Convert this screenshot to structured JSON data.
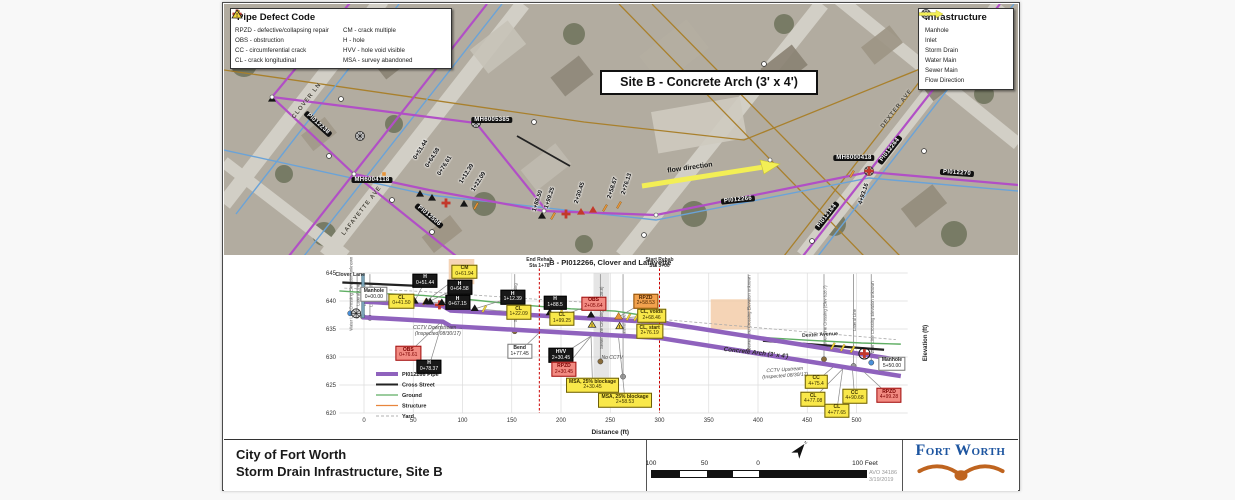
{
  "map": {
    "pipe_defect_legend": {
      "title": "Pipe Defect Code",
      "items": [
        {
          "sym": "tri",
          "color": "#c3392b",
          "code": "RPZD",
          "desc": "defective/collapsing repair"
        },
        {
          "sym": "cross",
          "color": "#c3392b",
          "code": "OBS",
          "desc": "obstruction"
        },
        {
          "sym": "tick",
          "color": "#e8963c",
          "code": "CC",
          "desc": "circumferential crack"
        },
        {
          "sym": "tick",
          "color": "#f0d23c",
          "code": "CL",
          "desc": "crack longitudinal"
        },
        {
          "sym": "tick",
          "color": "#e8963c",
          "code": "CM",
          "desc": "crack multiple"
        },
        {
          "sym": "tri",
          "color": "#151515",
          "code": "H",
          "desc": "hole"
        },
        {
          "sym": "tri",
          "color": "#151515",
          "code": "HVV",
          "desc": "hole void visible"
        },
        {
          "sym": "warn",
          "color": "#f2d43c",
          "code": "MSA",
          "desc": "survey abandoned"
        }
      ]
    },
    "infrastructure_legend": {
      "title": "Infrastructure",
      "items": [
        {
          "sym": "manhole",
          "color": "#333333",
          "label": "Manhole"
        },
        {
          "sym": "inlet",
          "color": "#333333",
          "label": "Inlet"
        },
        {
          "sym": "line",
          "color": "#b14fc6",
          "h": 2.6,
          "label": "Storm Drain"
        },
        {
          "sym": "line",
          "color": "#6aa3d8",
          "h": 1.4,
          "label": "Water Main"
        },
        {
          "sym": "line",
          "color": "#a9802c",
          "h": 1.4,
          "label": "Sewer Main"
        },
        {
          "sym": "arrow",
          "color": "#f3ef55",
          "label": "Flow Direction"
        }
      ]
    },
    "site_title": "Site B - Concrete Arch (3' x 4')",
    "labels": [
      {
        "text": "PI012238",
        "x": 94,
        "y": 120,
        "rot": 42,
        "cls": "pill"
      },
      {
        "text": "MH6005385",
        "x": 268,
        "y": 116,
        "rot": 0,
        "cls": "pill"
      },
      {
        "text": "MH6004118",
        "x": 148,
        "y": 176,
        "rot": 0,
        "cls": "pill"
      },
      {
        "text": "PI012506",
        "x": 205,
        "y": 212,
        "rot": 40,
        "cls": "pill"
      },
      {
        "text": "PI012266",
        "x": 514,
        "y": 196,
        "rot": -6,
        "cls": "pill"
      },
      {
        "text": "MH6000418",
        "x": 630,
        "y": 154,
        "rot": 0,
        "cls": "pill"
      },
      {
        "text": "PI012264",
        "x": 666,
        "y": 146,
        "rot": -52,
        "cls": "pill"
      },
      {
        "text": "PI012270",
        "x": 733,
        "y": 169,
        "rot": 4,
        "cls": "pill"
      },
      {
        "text": "PI012164",
        "x": 603,
        "y": 212,
        "rot": -52,
        "cls": "pill"
      },
      {
        "text": "CLOVER LN",
        "x": 83,
        "y": 97,
        "rot": -52,
        "cls": "street"
      },
      {
        "text": "LAFAYETTE AVE",
        "x": 138,
        "y": 207,
        "rot": -52,
        "cls": "street"
      },
      {
        "text": "DEXTER AVE",
        "x": 673,
        "y": 105,
        "rot": -52,
        "cls": "street"
      },
      {
        "text": "0+51.44",
        "x": 197,
        "y": 146,
        "rot": -58,
        "cls": "sta"
      },
      {
        "text": "0+64.58",
        "x": 209,
        "y": 154,
        "rot": -58,
        "cls": "sta"
      },
      {
        "text": "0+76.61",
        "x": 221,
        "y": 162,
        "rot": -58,
        "cls": "sta"
      },
      {
        "text": "1+12.39",
        "x": 243,
        "y": 170,
        "rot": -58,
        "cls": "sta"
      },
      {
        "text": "1+22.09",
        "x": 255,
        "y": 178,
        "rot": -58,
        "cls": "sta"
      },
      {
        "text": "1+88.50",
        "x": 314,
        "y": 197,
        "rot": -72,
        "cls": "sta"
      },
      {
        "text": "1+99.25",
        "x": 326,
        "y": 194,
        "rot": -72,
        "cls": "sta"
      },
      {
        "text": "2+30.45",
        "x": 356,
        "y": 189,
        "rot": -72,
        "cls": "sta"
      },
      {
        "text": "2+58.67",
        "x": 389,
        "y": 184,
        "rot": -72,
        "cls": "sta"
      },
      {
        "text": "2+76.13",
        "x": 403,
        "y": 180,
        "rot": -72,
        "cls": "sta"
      },
      {
        "text": "4+93.16",
        "x": 640,
        "y": 190,
        "rot": -72,
        "cls": "sta"
      },
      {
        "text": "flow direction",
        "x": 466,
        "y": 164,
        "rot": -8,
        "cls": "flow"
      }
    ],
    "markers": [
      {
        "x": 48,
        "y": 95,
        "t": "triBlack"
      },
      {
        "x": 136,
        "y": 132,
        "t": "manhole"
      },
      {
        "x": 252,
        "y": 119,
        "t": "manhole"
      },
      {
        "x": 645,
        "y": 167,
        "t": "manhole"
      },
      {
        "x": 645,
        "y": 167,
        "t": "crossRed"
      },
      {
        "x": 196,
        "y": 190,
        "t": "triBlack"
      },
      {
        "x": 208,
        "y": 194,
        "t": "triBlack"
      },
      {
        "x": 222,
        "y": 199,
        "t": "crossRed"
      },
      {
        "x": 240,
        "y": 200,
        "t": "triBlack"
      },
      {
        "x": 252,
        "y": 202,
        "t": "tickOrange"
      },
      {
        "x": 318,
        "y": 212,
        "t": "triBlack"
      },
      {
        "x": 329,
        "y": 212,
        "t": "tickOrange"
      },
      {
        "x": 342,
        "y": 210,
        "t": "crossRed"
      },
      {
        "x": 357,
        "y": 208,
        "t": "triRed"
      },
      {
        "x": 369,
        "y": 206,
        "t": "triRed"
      },
      {
        "x": 381,
        "y": 204,
        "t": "tickOrange"
      },
      {
        "x": 395,
        "y": 201,
        "t": "tickOrange"
      },
      {
        "x": 628,
        "y": 170,
        "t": "tickOrange"
      },
      {
        "x": 160,
        "y": 170,
        "t": "sqOrange"
      },
      {
        "x": 105,
        "y": 152,
        "t": "inlet"
      },
      {
        "x": 168,
        "y": 196,
        "t": "inlet"
      },
      {
        "x": 208,
        "y": 228,
        "t": "inlet"
      },
      {
        "x": 310,
        "y": 118,
        "t": "inlet"
      },
      {
        "x": 420,
        "y": 231,
        "t": "inlet"
      },
      {
        "x": 588,
        "y": 237,
        "t": "inlet"
      },
      {
        "x": 700,
        "y": 147,
        "t": "inlet"
      },
      {
        "x": 117,
        "y": 95,
        "t": "inlet"
      },
      {
        "x": 540,
        "y": 60,
        "t": "inlet"
      },
      {
        "x": 48,
        "y": 93,
        "t": "dotWhite"
      },
      {
        "x": 130,
        "y": 170,
        "t": "dotWhite"
      },
      {
        "x": 320,
        "y": 207,
        "t": "dotWhite"
      },
      {
        "x": 432,
        "y": 211,
        "t": "dotWhite"
      },
      {
        "x": 546,
        "y": 156,
        "t": "dotWhite"
      }
    ]
  },
  "chart_data": {
    "type": "line",
    "title": "B - PI012266, Clover and Lafayette",
    "xlabel": "Distance (ft)",
    "ylabel": "Elevation (ft)",
    "xlim": [
      -25,
      560
    ],
    "ylim": [
      620,
      645
    ],
    "xticks": [
      0,
      50,
      100,
      150,
      200,
      250,
      300,
      350,
      400,
      450,
      500
    ],
    "yticks": [
      620,
      625,
      630,
      635,
      640,
      645
    ],
    "grid": true,
    "legend": [
      {
        "label": "PI012266 Pipe",
        "color": "#8f62bd",
        "width": 4
      },
      {
        "label": "Cross Street",
        "color": "#222222",
        "width": 2
      },
      {
        "label": "Ground",
        "color": "#5fae63",
        "width": 1.2
      },
      {
        "label": "Structure",
        "color": "#e8853d",
        "width": 1.2
      },
      {
        "label": "Yard",
        "color": "#999999",
        "width": 0.8,
        "dash": "3,2"
      }
    ],
    "series": [
      {
        "name": "Yard",
        "color": "#aaaaaa",
        "width": 0.8,
        "dash": "3,2",
        "points": [
          [
            -20,
            642.3
          ],
          [
            60,
            641.7
          ],
          [
            150,
            640.6
          ],
          [
            240,
            639.6
          ]
        ]
      },
      {
        "name": "Yard2",
        "color": "#aaaaaa",
        "width": 0.8,
        "dash": "3,2",
        "points": [
          [
            310,
            636.6
          ],
          [
            540,
            633.1
          ]
        ]
      },
      {
        "name": "Ground",
        "color": "#5fae63",
        "width": 1.4,
        "points": [
          [
            -25,
            641.8
          ],
          [
            0,
            641.5
          ],
          [
            60,
            641
          ],
          [
            110,
            640.2
          ],
          [
            160,
            639.3
          ],
          [
            210,
            638.6
          ],
          [
            255,
            638.2
          ],
          [
            285,
            637.4
          ],
          [
            310,
            636.2
          ],
          [
            345,
            634.8
          ],
          [
            395,
            633.6
          ],
          [
            450,
            633
          ],
          [
            505,
            632.5
          ],
          [
            545,
            632.3
          ]
        ]
      },
      {
        "name": "Clover Lane",
        "color": "#222222",
        "width": 2.2,
        "points": [
          [
            -22,
            643.3
          ],
          [
            55,
            642.7
          ]
        ]
      },
      {
        "name": "Dexter Avenue",
        "color": "#222222",
        "width": 2.2,
        "points": [
          [
            405,
            632.9
          ],
          [
            528,
            631.3
          ]
        ]
      },
      {
        "name": "Pipe top",
        "color": "#8f62bd",
        "width": 4.5,
        "points": [
          [
            -2,
            639.9
          ],
          [
            80,
            639.1
          ],
          [
            88,
            638.3
          ],
          [
            300,
            636.2
          ],
          [
            545,
            629.4
          ]
        ]
      },
      {
        "name": "Pipe bottom",
        "color": "#8f62bd",
        "width": 4.5,
        "points": [
          [
            -2,
            637.1
          ],
          [
            80,
            636.3
          ],
          [
            88,
            635.5
          ],
          [
            300,
            633.4
          ],
          [
            545,
            626.6
          ]
        ]
      }
    ],
    "structures": [
      {
        "x1": 86,
        "x2": 112,
        "y1": 647.5,
        "y2": 643
      },
      {
        "x1": 352,
        "x2": 392,
        "y1": 640.3,
        "y2": 634.9
      }
    ],
    "shaded_bands": [
      {
        "x1": 233,
        "x2": 249,
        "y1": 645,
        "y2": 626
      }
    ],
    "vlines": [
      {
        "x": 178,
        "label1": "End Rehab",
        "label2": "Sta 1+78"
      },
      {
        "x": 300,
        "label1": "Start Rehab",
        "label2": "Sta 3+00"
      }
    ],
    "crossings": [
      {
        "x": -14,
        "label": "Water Line Crossing Elevation unknown",
        "color": "#4a90d9",
        "cy": 637.8
      },
      {
        "x": -7,
        "label": "Lateral Line",
        "color": "#999999",
        "cy": 637.4
      },
      {
        "x": -1,
        "label": "Lateral Line",
        "color": "#999999",
        "cy": 637.2
      },
      {
        "x": 6,
        "label": "Lateral Line",
        "color": "#999999",
        "cy": 637.0
      },
      {
        "x": 153,
        "label": "Sewer Line Crossing",
        "color": "#8a6d3b",
        "cy": 634.6
      },
      {
        "x": 240,
        "label": "Sewer Line Crossing (Elev 628.8)",
        "color": "#8a6d3b",
        "cy": 629.2
      },
      {
        "x": 263,
        "label": "Lateral Line",
        "color": "#999999",
        "cy": 626.5
      },
      {
        "x": 390,
        "label": "Sewer Line Crossing Elevation unknown",
        "color": "#8a6d3b",
        "cy": 631.0
      },
      {
        "x": 467,
        "label": "Sewer Line Crossing (Elev 628.7)",
        "color": "#8a6d3b",
        "cy": 629.6
      },
      {
        "x": 497,
        "label": "Lateral Line",
        "color": "#999999",
        "cy": 628.4
      },
      {
        "x": 515,
        "label": "Water Line Crossing Elevation unknown",
        "color": "#4a90d9",
        "cy": 629.0
      }
    ],
    "annotations": [
      {
        "c": "Manhole",
        "s": "0+00.00",
        "k": "white",
        "x": 10,
        "y": 641.2,
        "mx": 0
      },
      {
        "c": "CL",
        "s": "0+41.50",
        "k": "yellow",
        "x": 38,
        "y": 640,
        "mx": 41.5
      },
      {
        "c": "H",
        "s": "0+51.44",
        "k": "black",
        "x": 62,
        "y": 643.6,
        "mx": 51.4
      },
      {
        "c": "CM",
        "s": "0+61.94",
        "k": "yellow",
        "x": 102,
        "y": 645.2,
        "mx": 61.9
      },
      {
        "c": "H",
        "s": "0+64.58",
        "k": "black",
        "x": 97,
        "y": 642.5,
        "mx": 64.6
      },
      {
        "c": "H",
        "s": "0+67.15",
        "k": "black",
        "x": 95,
        "y": 639.8,
        "mx": 67.2
      },
      {
        "c": "H",
        "s": "1+12.39",
        "k": "black",
        "x": 151,
        "y": 640.7,
        "mx": 112.4
      },
      {
        "c": "CL",
        "s": "1+22.09",
        "k": "yellow",
        "x": 157,
        "y": 638,
        "mx": 122.1
      },
      {
        "c": "H",
        "s": "1+88.5",
        "k": "black",
        "x": 194,
        "y": 639.7,
        "mx": 188.5
      },
      {
        "c": "OBS",
        "s": "2+05.64",
        "k": "red",
        "x": 233,
        "y": 639.5,
        "mx": 205.6
      },
      {
        "c": "CL",
        "s": "1+99.25",
        "k": "yellow",
        "x": 201,
        "y": 636.8,
        "mx": 199.3
      },
      {
        "c": "RPZD",
        "s": "2+58.53",
        "k": "orange",
        "x": 286,
        "y": 640,
        "mx": 258.5
      },
      {
        "c": "CL, voids",
        "s": "2+68.46",
        "k": "yellow",
        "x": 292,
        "y": 637.4,
        "mx": 268.5
      },
      {
        "c": "CL, start",
        "s": "2+76.19",
        "k": "yellow",
        "x": 290,
        "y": 634.6,
        "mx": 276.2
      },
      {
        "c": "OBS",
        "s": "0+76.61",
        "k": "red",
        "x": 45,
        "y": 630.7,
        "mx": 76.6
      },
      {
        "c": "H",
        "s": "0+78.37",
        "k": "black",
        "x": 66,
        "y": 628.3,
        "mx": 79
      },
      {
        "c": "Bend",
        "s": "1+77.45",
        "k": "white",
        "x": 158,
        "y": 631,
        "mx": 177.5
      },
      {
        "c": "HVV",
        "s": "2+30.45",
        "k": "black",
        "x": 200,
        "y": 630.3,
        "mx": 230.5
      },
      {
        "c": "RPZD",
        "s": "2+30.45",
        "k": "red",
        "x": 203,
        "y": 627.8,
        "mx": 230.5
      },
      {
        "c": "MSA, 25% blockage",
        "s": "2+30.45",
        "k": "yellow",
        "x": 232,
        "y": 625,
        "mx": 230.5
      },
      {
        "c": "MSA, 25% blockage",
        "s": "2+58.53",
        "k": "yellow",
        "x": 265,
        "y": 622.3,
        "mx": 258.5
      },
      {
        "c": "CC",
        "s": "4+75.4",
        "k": "yellow",
        "x": 459,
        "y": 625.6,
        "mx": 476
      },
      {
        "c": "CL",
        "s": "4+77.08",
        "k": "yellow",
        "x": 456,
        "y": 622.5,
        "mx": 486
      },
      {
        "c": "CL",
        "s": "4+77.65",
        "k": "yellow",
        "x": 480,
        "y": 620.4,
        "mx": 486
      },
      {
        "c": "CC",
        "s": "4+90.68",
        "k": "yellow",
        "x": 498,
        "y": 623,
        "mx": 496
      },
      {
        "c": "RPZD",
        "s": "4+99.28",
        "k": "red",
        "x": 533,
        "y": 623.2,
        "mx": 508
      },
      {
        "c": "Manhole",
        "s": "5+50.00",
        "k": "white",
        "x": 536,
        "y": 628.8,
        "mx": 543
      }
    ],
    "markers": [
      {
        "x": 41.5,
        "t": "tickYellow"
      },
      {
        "x": 51.4,
        "t": "triBlack"
      },
      {
        "x": 61.9,
        "t": "tickOrange"
      },
      {
        "x": 63.5,
        "t": "triBlack"
      },
      {
        "x": 67.2,
        "t": "triBlack"
      },
      {
        "x": 76.6,
        "t": "crossRed"
      },
      {
        "x": 79,
        "t": "triBlack"
      },
      {
        "x": 112.4,
        "t": "triBlack"
      },
      {
        "x": 122.1,
        "t": "tickYellow"
      },
      {
        "x": 188.5,
        "t": "triBlack"
      },
      {
        "x": 199.3,
        "t": "tickYellow"
      },
      {
        "x": 205.6,
        "t": "crossRed"
      },
      {
        "x": 230.5,
        "t": "triBlack"
      },
      {
        "x": 231.5,
        "t": "warnYellow"
      },
      {
        "x": 258.5,
        "t": "triOrange"
      },
      {
        "x": 259.5,
        "t": "warnYellow"
      },
      {
        "x": 268.5,
        "t": "tickYellow"
      },
      {
        "x": 276.2,
        "t": "tickYellow"
      },
      {
        "x": 476,
        "t": "tickYellow"
      },
      {
        "x": 486,
        "t": "tickYellow"
      },
      {
        "x": 496,
        "t": "tickYellow"
      },
      {
        "x": 508,
        "t": "crossCircled"
      },
      {
        "x": 543,
        "t": "dotTeal"
      }
    ],
    "notes": [
      {
        "x": 75,
        "y": 634.6,
        "rot": 0,
        "cls": "cctv",
        "t1": "CCTV Downstream →",
        "t2": "(Inspected 08/30/17)"
      },
      {
        "x": 427,
        "y": 627.2,
        "rot": -4,
        "cls": "cctv",
        "t1": "CCTV Upstream",
        "t2": "(Inspected 08/30/17)"
      },
      {
        "x": 252,
        "y": 629.8,
        "rot": 0,
        "cls": "cctv",
        "t1": "No CCTV",
        "t2": ""
      },
      {
        "x": 398,
        "y": 630.8,
        "rot": 6.5,
        "cls": "pipe-name",
        "t1": "Concrete Arch (3' x 4')",
        "t2": ""
      },
      {
        "x": -14,
        "y": 644.6,
        "rot": 0,
        "cls": "street-note",
        "t1": "Clover Lane",
        "t2": ""
      },
      {
        "x": 463,
        "y": 633.9,
        "rot": -3,
        "cls": "street-note",
        "t1": "Dexter Avenue",
        "t2": ""
      }
    ]
  },
  "title_block": {
    "line1": "City of Fort Worth",
    "line2": "Storm Drain Infrastructure, Site B",
    "scale_labels": [
      "100",
      "50",
      "0",
      "100 Feet"
    ],
    "avo": "AVO 34186",
    "date": "3/19/2019",
    "logo_text": "Fort Worth"
  }
}
